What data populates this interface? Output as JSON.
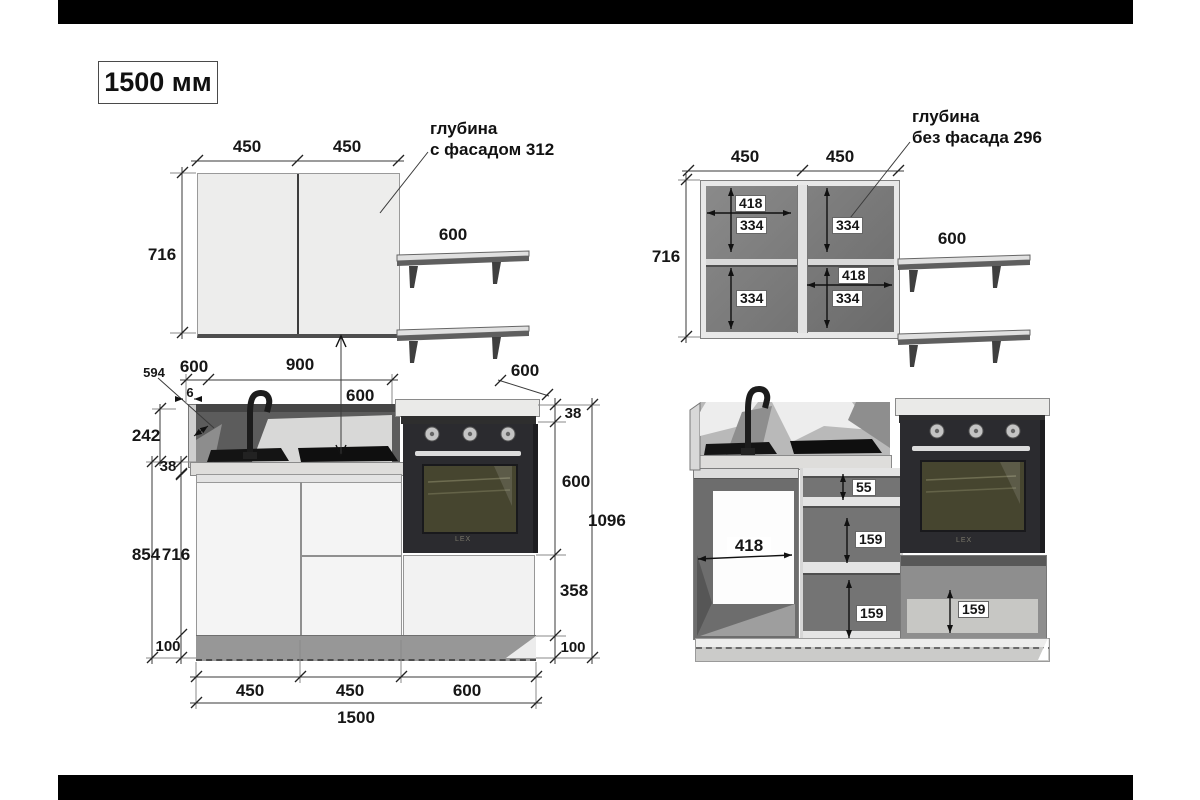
{
  "title": "1500 мм",
  "wall_closed": {
    "w_left": "450",
    "w_right": "450",
    "height": "716",
    "shelf": "600",
    "note1": "глубина",
    "note2": "с фасадом 312"
  },
  "wall_open": {
    "w_left": "450",
    "w_right": "450",
    "height": "716",
    "shelf": "600",
    "note1": "глубина",
    "note2": "без фасада 296",
    "inner_w_tl": "418",
    "inner_h_tl": "334",
    "inner_h_bl": "334",
    "inner_h_tr": "334",
    "inner_w_br": "418",
    "inner_h_br": "334"
  },
  "base_closed": {
    "side_panel": "594",
    "depth_left": "600",
    "apron_w": "900",
    "gap": "6",
    "hang": "600",
    "apron_h": "242",
    "top_thick": "38",
    "total_h": "854",
    "carcass_h": "716",
    "plinth": "100",
    "oven_depth": "600",
    "oven_top_thick": "38",
    "oven_h": "600",
    "total_right": "1096",
    "drawer_h": "358",
    "plinth_r": "100",
    "w1": "450",
    "w2": "450",
    "w3": "600",
    "total_w": "1500",
    "oven_brand": "LEX"
  },
  "base_open": {
    "sink_w": "418",
    "top_gap": "55",
    "drawer1": "159",
    "drawer2": "159",
    "oven_drawer": "159",
    "oven_brand": "LEX"
  }
}
